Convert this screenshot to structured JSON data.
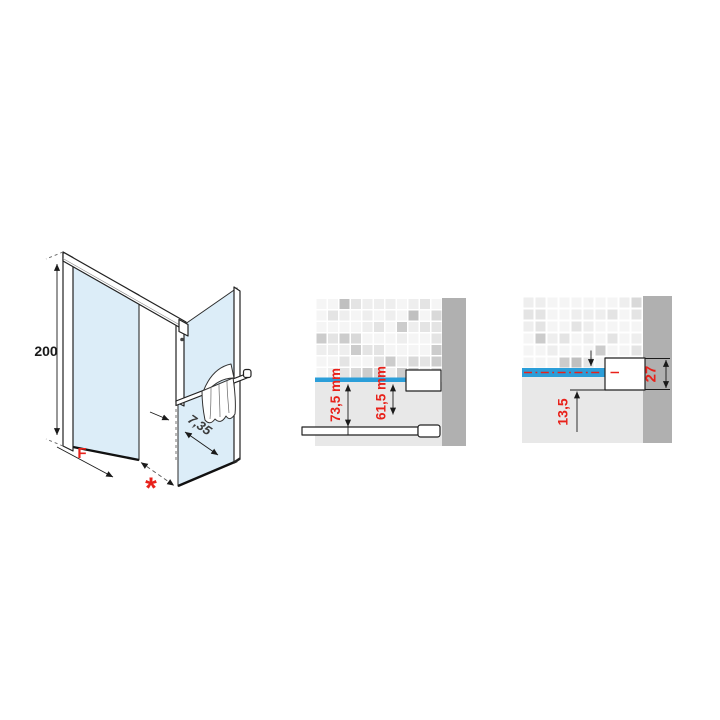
{
  "diagram": {
    "type": "shower-enclosure-technical-drawing",
    "iso_view": {
      "height_label": "200",
      "fixed_width_label": "F",
      "opening_label": "*",
      "gap_label": "7,35"
    },
    "detail_left": {
      "dim_outer": "73,5 mm",
      "dim_inner": "61,5 mm"
    },
    "detail_right": {
      "dim_offset": "13,5",
      "dim_profile": "27"
    },
    "colors": {
      "glass": "#dcedf8",
      "accent_blue": "#2b9ed9",
      "dimension_red": "#e8211a",
      "wall_gray": "#b0b0b0",
      "floor_gray": "#e8e8e8",
      "line": "#1a1a1a",
      "tile_palette": [
        "#f5f5f5",
        "#eeeeee",
        "#e4e4e4",
        "#d9d9d9",
        "#cccccc",
        "#c0c0c0"
      ]
    }
  }
}
